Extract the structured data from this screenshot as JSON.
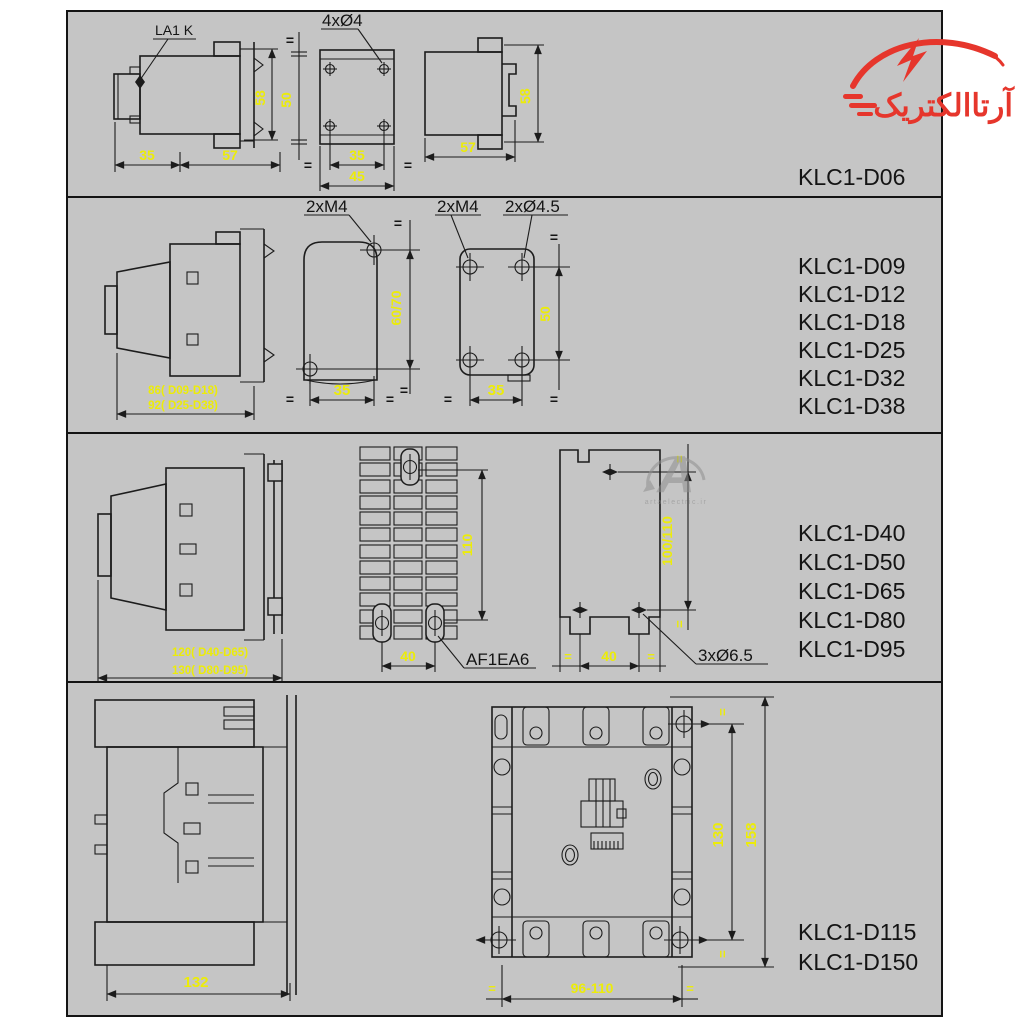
{
  "panel": {
    "bg": "#c5c5c5",
    "border": "#141414"
  },
  "colors": {
    "dim_text": "#ecec09",
    "line": "#1c1c1c",
    "label": "#141414",
    "logo_red": "#e6362c",
    "watermark": "#8f8f8f"
  },
  "symbols": {
    "eq": "="
  },
  "logo": {
    "text": "آرتاالکتریک"
  },
  "watermark": {
    "letter": "A",
    "caption": "artaelectric.ir"
  },
  "sections": [
    {
      "models": [
        "KLC1-D06"
      ],
      "labels": {
        "la1k": "LA1 K",
        "holes": "4xØ4"
      },
      "dims": {
        "h58_left": "58",
        "w35": "35",
        "w57_left": "57",
        "v50": "50",
        "w35_mid": "35",
        "w45": "45",
        "h58_right": "58",
        "w57_right": "57"
      }
    },
    {
      "models": [
        "KLC1-D09",
        "KLC1-D12",
        "KLC1-D18",
        "KLC1-D25",
        "KLC1-D32",
        "KLC1-D38"
      ],
      "labels": {
        "m4_mid": "2xM4",
        "m4_right": "2xM4",
        "dia45": "2xØ4.5"
      },
      "dims": {
        "depth_a": "86( D09-D18)",
        "depth_b": "92( D25-D38)",
        "v6070": "60/70",
        "w35_mid": "35",
        "v50": "50",
        "w35_right": "35"
      }
    },
    {
      "models": [
        "KLC1-D40",
        "KLC1-D50",
        "KLC1-D65",
        "KLC1-D80",
        "KLC1-D95"
      ],
      "labels": {
        "af1ea6": "AF1EA6",
        "dia65": "3xØ6.5"
      },
      "dims": {
        "depth_a": "120( D40-D65)",
        "depth_b": "130( D80-D95)",
        "v110": "110",
        "w40_mid": "40",
        "v100110": "100/110",
        "w40_right": "40"
      }
    },
    {
      "models": [
        "KLC1-D115",
        "KLC1-D150"
      ],
      "dims": {
        "w132": "132",
        "v130": "130",
        "v158": "158",
        "w96110": "96-110"
      }
    }
  ]
}
